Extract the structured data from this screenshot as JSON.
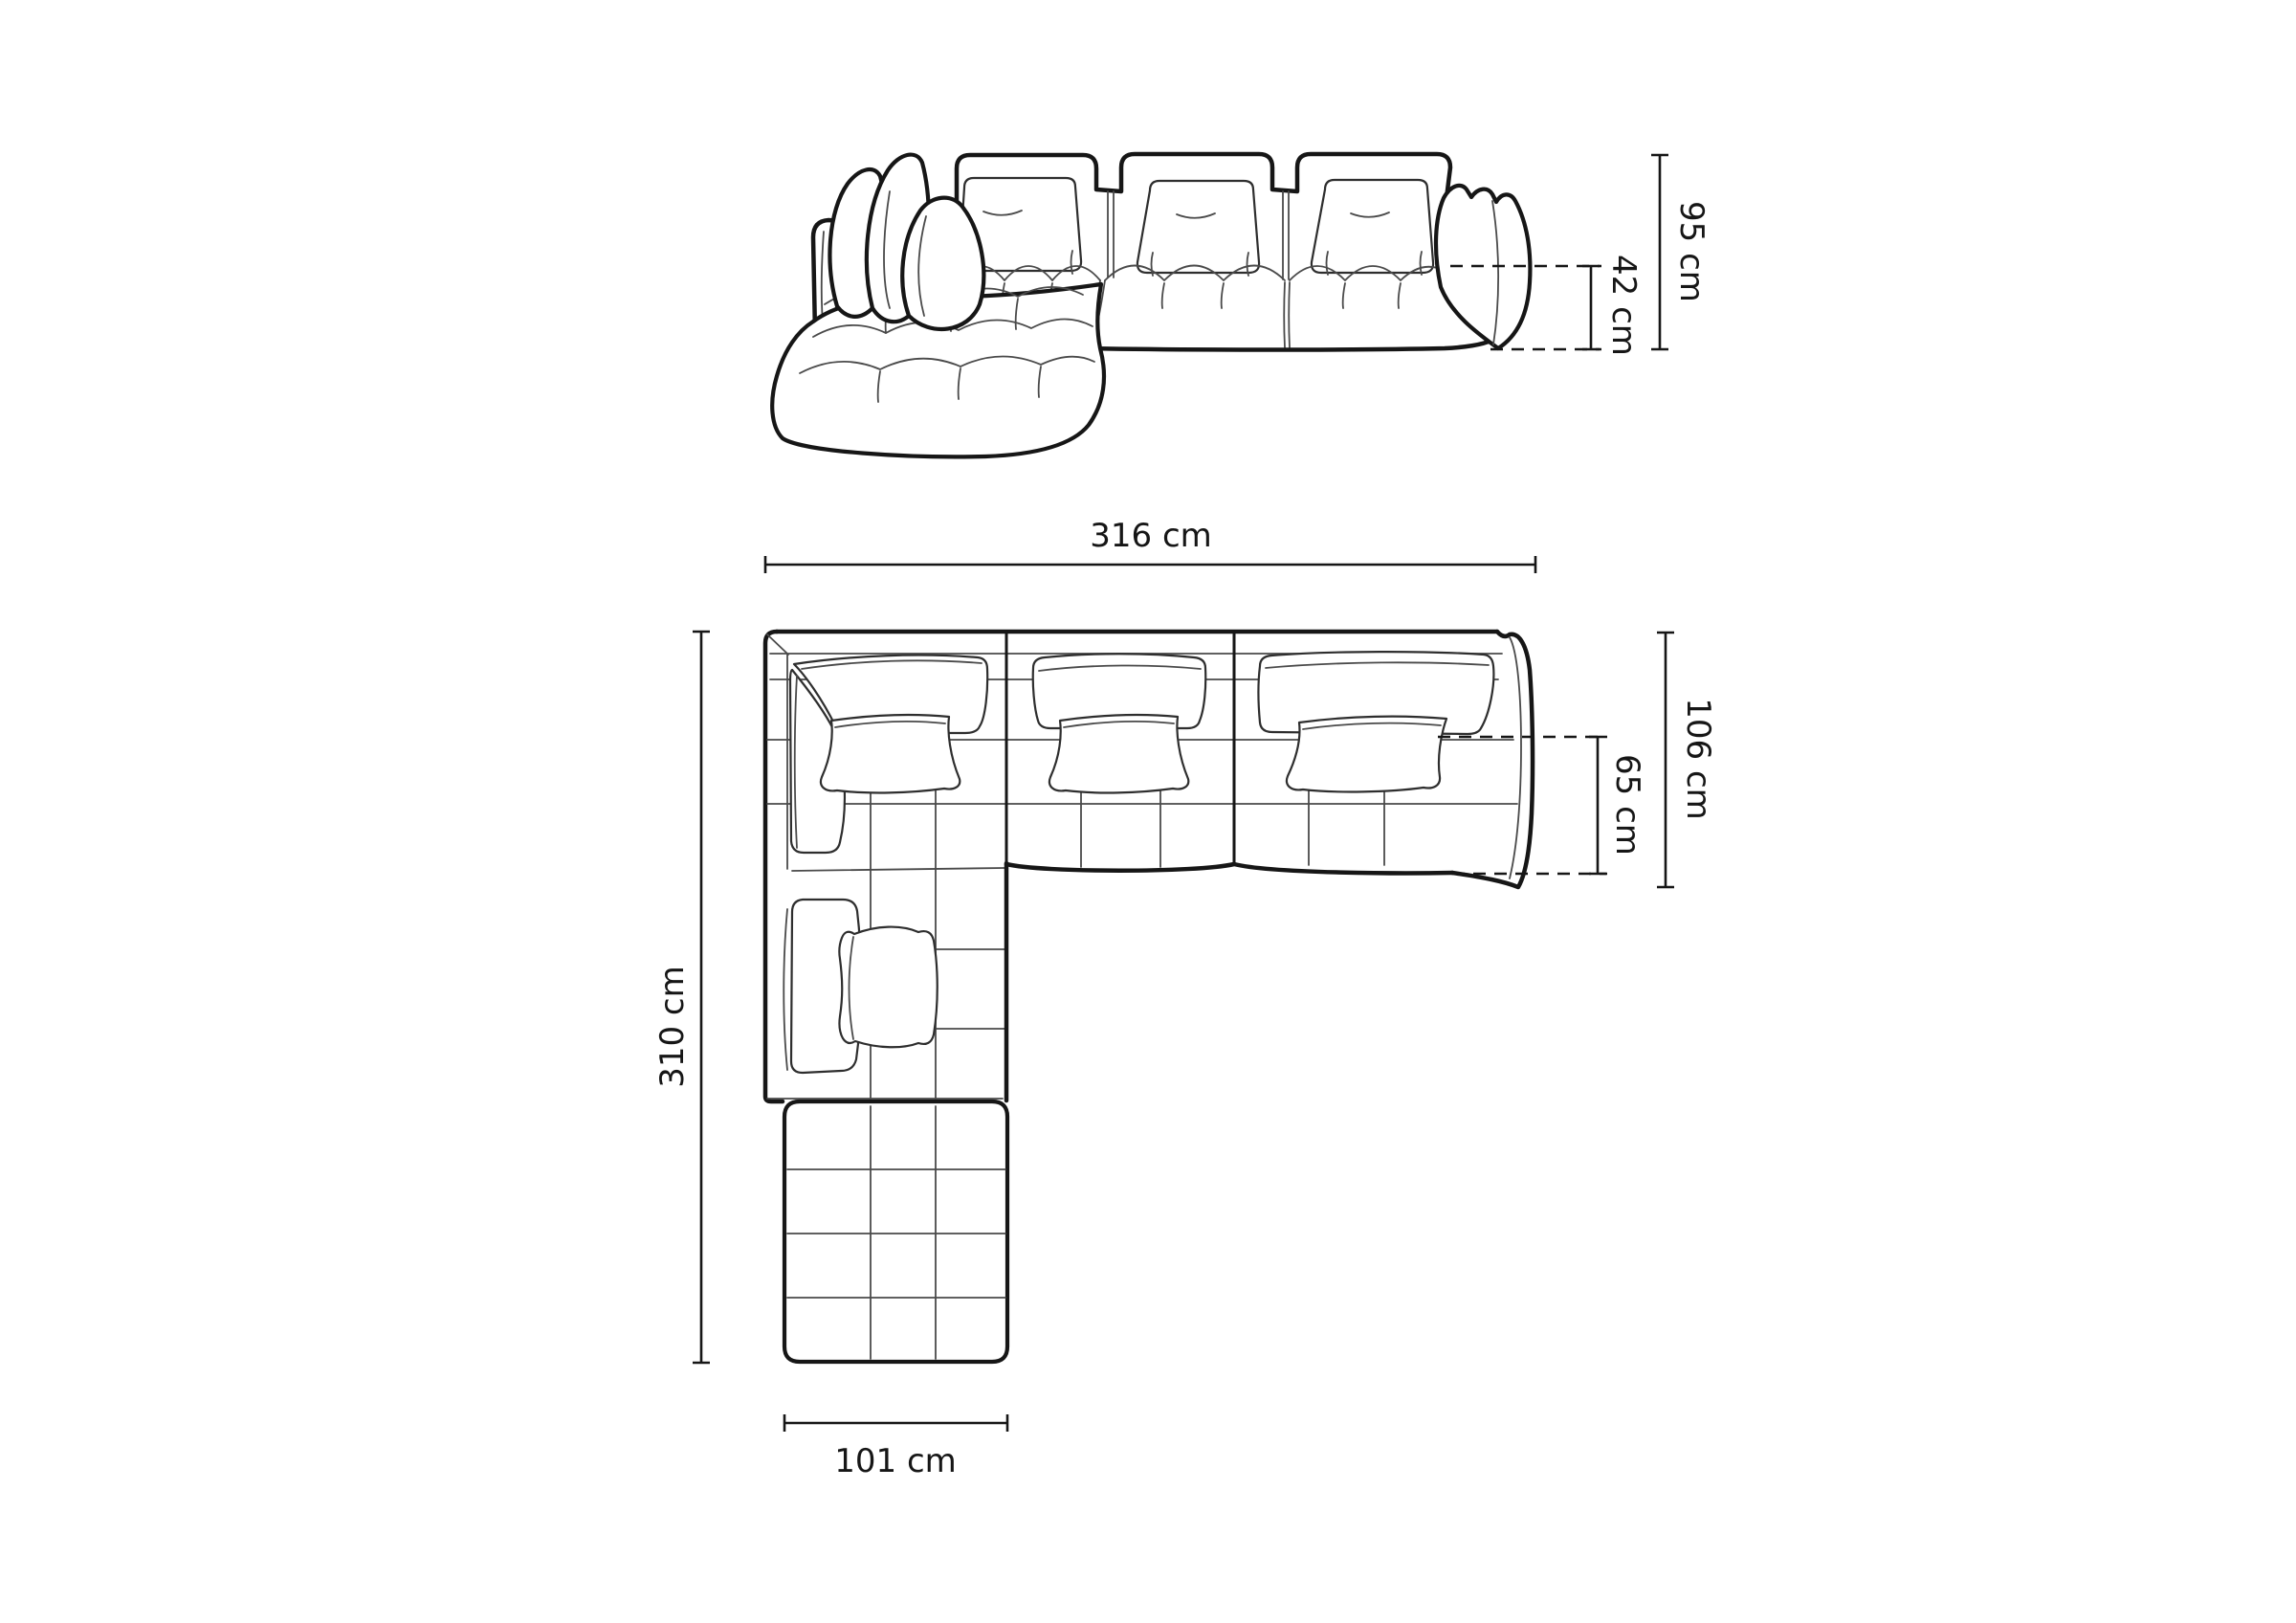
{
  "diagram": {
    "front_view": {
      "overall_height": "95 cm",
      "seat_height": "42 cm"
    },
    "top_view": {
      "overall_width": "316 cm",
      "overall_depth": "310 cm",
      "side_depth": "106 cm",
      "seat_depth": "65 cm",
      "chaise_width": "101 cm"
    },
    "colors": {
      "line": "#161616",
      "background": "#ffffff"
    }
  }
}
